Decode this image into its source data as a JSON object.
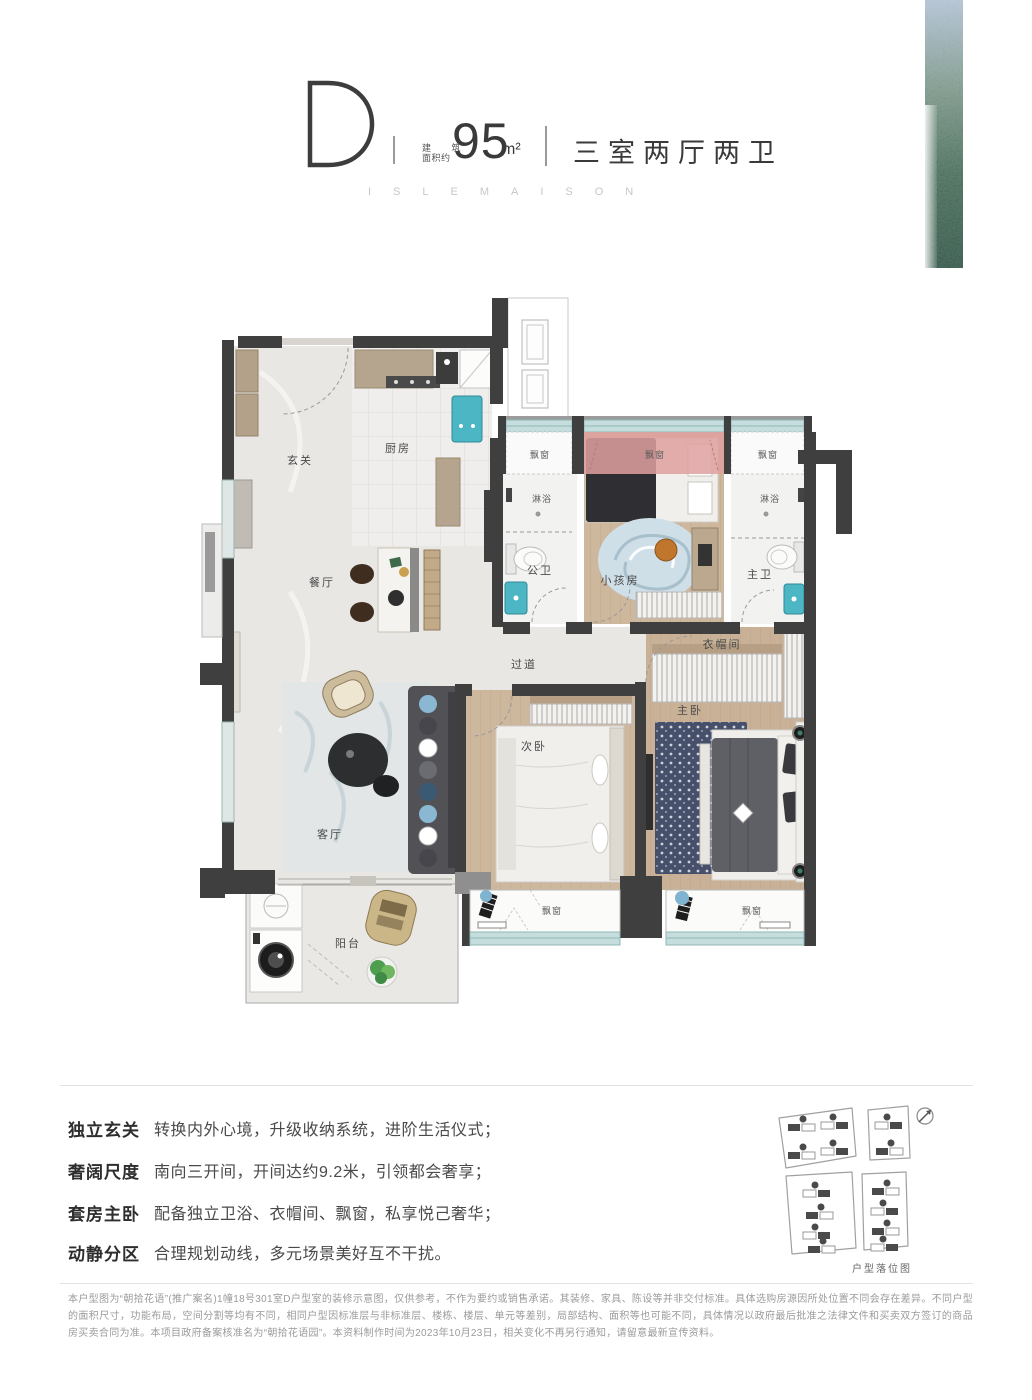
{
  "header": {
    "unit_letter": "D",
    "area_label_line1": "建 筑",
    "area_label_line2": "面积约",
    "area_value": "95",
    "area_unit": "m²",
    "rooms_summary": "三室两厅两卫",
    "brand_caption": "ISLEMAISON"
  },
  "floorplan": {
    "labels": {
      "foyer": "玄关",
      "kitchen": "厨房",
      "dining": "餐厅",
      "living": "客厅",
      "balcony": "阳台",
      "hallway": "过道",
      "second_bedroom": "次卧",
      "master_bedroom": "主卧",
      "closet": "衣帽间",
      "kids_room": "小孩房",
      "guest_bath": "公卫",
      "master_bath": "主卫",
      "shower": "淋浴",
      "bay_window": "飘窗"
    },
    "colors": {
      "wall_dark": "#3f3f3f",
      "wall_gray": "#8f8f8f",
      "bay_highlight_pink": "#dfa0a0",
      "window_glass_teal": "#c5dedd",
      "sink_teal": "#4cb6c4",
      "wood_floor": "#cdb79d",
      "marble_floor": "#e9e7e4"
    }
  },
  "features": [
    {
      "title": "独立玄关",
      "desc": "转换内外心境，升级收纳系统，进阶生活仪式；"
    },
    {
      "title": "奢阔尺度",
      "desc": "南向三开间，开间达约9.2米，引领都会奢享；"
    },
    {
      "title": "套房主卧",
      "desc": "配备独立卫浴、衣帽间、飘窗，私享悦己奢华；"
    },
    {
      "title": "动静分区",
      "desc": "合理规划动线，多元场景美好互不干扰。"
    }
  ],
  "legend": {
    "caption": "户型落位图"
  },
  "disclaimer": {
    "text": "本户型图为“朝拾花语”(推广案名)1幢18号301室D户型室的装修示意图，仅供参考，不作为要约或销售承诺。其装修、家具、陈设等并非交付标准。具体选购房源因所处位置不同会存在差异。不同户型的面积尺寸，功能布局，空间分割等均有不同，相同户型因标准层与非标准层、楼栋、楼层、单元等差别，局部结构、面积等也可能不同，具体情况以政府最后批准之法律文件和买卖双方签订的商品房买卖合同为准。本项目政府备案核准名为“朝拾花语园”。本资料制作时间为2023年10月23日，相关变化不再另行通知，请留意最新宣传资料。"
  }
}
